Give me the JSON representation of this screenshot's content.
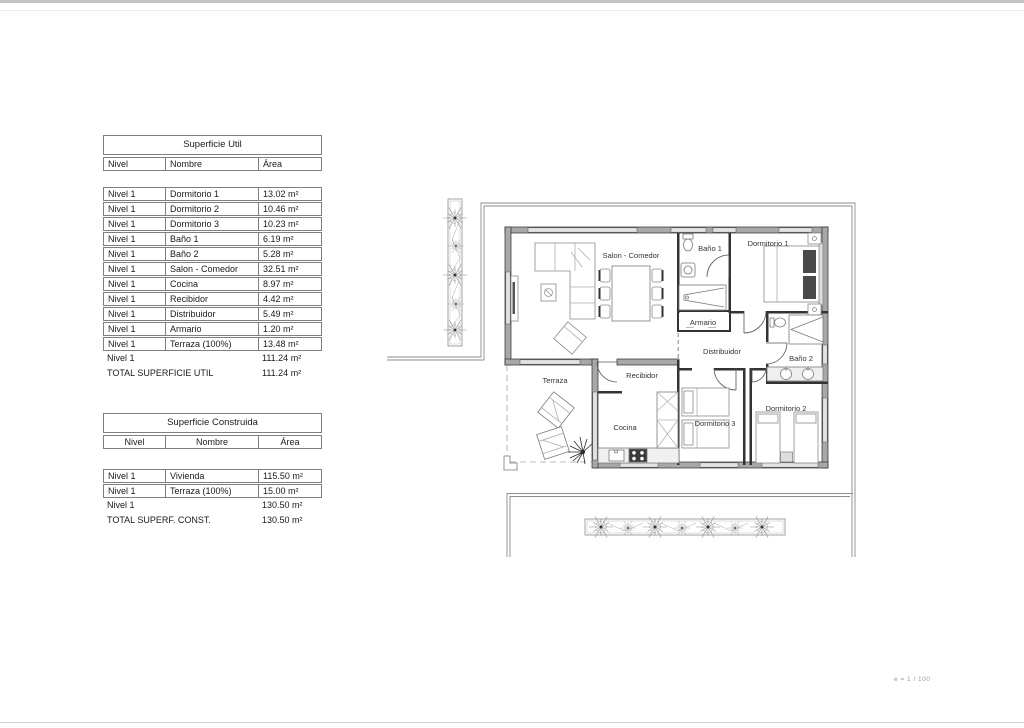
{
  "page": {
    "scale_note": "e = 1 / 100"
  },
  "tables": {
    "util": {
      "title": "Superficie Util",
      "headers": {
        "nivel": "Nivel",
        "nombre": "Nombre",
        "area": "Área"
      },
      "rows": [
        {
          "nivel": "Nivel 1",
          "nombre": "Dormitorio 1",
          "area": "13.02 m²"
        },
        {
          "nivel": "Nivel 1",
          "nombre": "Dormitorio 2",
          "area": "10.46 m²"
        },
        {
          "nivel": "Nivel 1",
          "nombre": "Dormitorio 3",
          "area": "10.23 m²"
        },
        {
          "nivel": "Nivel 1",
          "nombre": "Baño 1",
          "area": "6.19 m²"
        },
        {
          "nivel": "Nivel 1",
          "nombre": "Baño 2",
          "area": "5.28 m²"
        },
        {
          "nivel": "Nivel 1",
          "nombre": "Salon - Comedor",
          "area": "32.51 m²"
        },
        {
          "nivel": "Nivel 1",
          "nombre": "Cocina",
          "area": "8.97 m²"
        },
        {
          "nivel": "Nivel 1",
          "nombre": "Recibidor",
          "area": "4.42 m²"
        },
        {
          "nivel": "Nivel 1",
          "nombre": "Distribuidor",
          "area": "5.49 m²"
        },
        {
          "nivel": "Nivel 1",
          "nombre": "Armario",
          "area": "1.20 m²"
        },
        {
          "nivel": "Nivel 1",
          "nombre": "Terraza (100%)",
          "area": "13.48 m²"
        }
      ],
      "subtotal": {
        "nivel": "Nivel 1",
        "area": "111.24 m²"
      },
      "total": {
        "label": "TOTAL SUPERFICIE UTIL",
        "area": "111.24 m²"
      }
    },
    "construida": {
      "title": "Superficie Construida",
      "headers": {
        "nivel": "Nivel",
        "nombre": "Nombre",
        "area": "Área"
      },
      "rows": [
        {
          "nivel": "Nivel 1",
          "nombre": "Vivienda",
          "area": "115.50 m²"
        },
        {
          "nivel": "Nivel 1",
          "nombre": "Terraza (100%)",
          "area": "15.00 m²"
        }
      ],
      "subtotal": {
        "nivel": "Nivel 1",
        "area": "130.50 m²"
      },
      "total": {
        "label": "TOTAL SUPERF. CONST.",
        "area": "130.50 m²"
      }
    }
  },
  "plan": {
    "rooms": {
      "salon": "Salon - Comedor",
      "bano1": "Baño 1",
      "dormitorio1": "Dormitorio 1",
      "armario": "Armario",
      "distribuidor": "Distribuidor",
      "bano2": "Baño 2",
      "recibidor": "Recibidor",
      "terraza": "Terraza",
      "cocina": "Cocina",
      "dormitorio3": "Dormitorio 3",
      "dormitorio2": "Dormitorio 2"
    }
  },
  "colors": {
    "wall_fill": "#a8a8a8",
    "window_fill": "#e2e2e2",
    "line": "#777777"
  }
}
